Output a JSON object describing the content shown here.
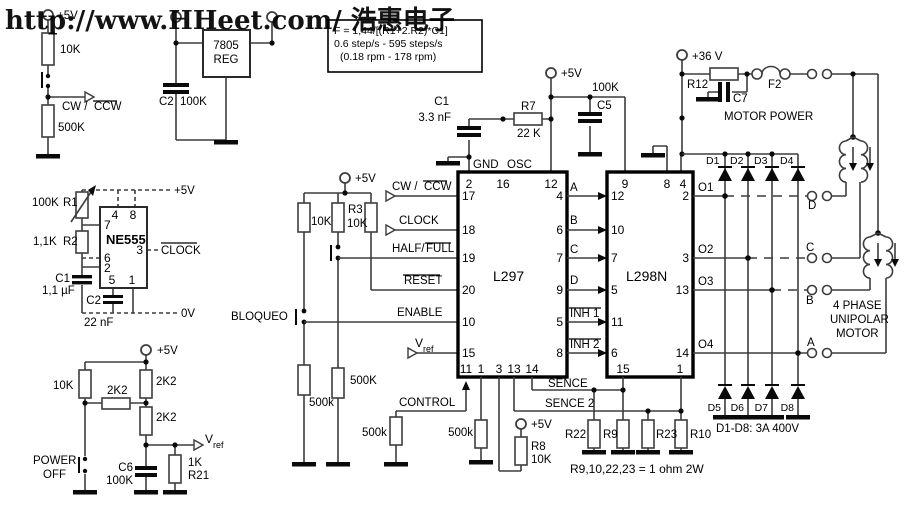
{
  "watermark": {
    "text": "http://www.HHeet.com/ 浩惠电子",
    "color": "#e60000"
  },
  "formula_box": {
    "line1": "F = 1,44/[(R1+2.R2)*C1]",
    "line2": "0.6 step/s - 595 steps/s",
    "line3": "(0.18 rpm - 178 rpm)"
  },
  "supply": {
    "v5": "+5V",
    "v36": "+36 V",
    "v0": "0V",
    "motor_power": "MOTOR POWER"
  },
  "chips": {
    "l297": {
      "name": "L297",
      "top": [
        "2",
        "16",
        "12"
      ],
      "left": [
        "17",
        "18",
        "19",
        "20",
        "10",
        "15"
      ],
      "right": [
        "4",
        "6",
        "7",
        "9",
        "5",
        "8"
      ],
      "bottom": [
        "11",
        "1",
        "3",
        "13",
        "14"
      ]
    },
    "l298": {
      "name": "L298N",
      "top": [
        "9",
        "8",
        "4"
      ],
      "left": [
        "12",
        "10",
        "7",
        "5",
        "11",
        "6"
      ],
      "right": [
        "2",
        "3",
        "13",
        "14"
      ],
      "bottom": [
        "15",
        "1"
      ]
    },
    "ne555": {
      "name": "NE555",
      "pins": [
        "4",
        "8",
        "7",
        "6",
        "2",
        "3",
        "5",
        "1"
      ]
    },
    "reg": {
      "line1": "7805",
      "line2": "REG"
    }
  },
  "signals": {
    "cw": "CW /",
    "ccw": "CCW",
    "clock": "CLOCK",
    "half": "HALF/",
    "full": "FULL",
    "reset": "RESET",
    "enable": "ENABLE",
    "control": "CONTROL",
    "bloqueo": "BLOQUEO",
    "sence": "SENCE",
    "sence2": "SENCE 2",
    "inh1": "INH 1",
    "inh2": "INH 2",
    "gnd": "GND",
    "osc": "OSC",
    "vref_v": "V",
    "vref_sub": "ref",
    "o1": "O1",
    "o2": "O2",
    "o3": "O3",
    "o4": "O4",
    "a": "A",
    "b": "B",
    "c": "C",
    "d": "D",
    "power": "POWER",
    "off": "OFF"
  },
  "components": {
    "r10k": "10K",
    "r500K": "500K",
    "r500k": "500k",
    "r2k2": "2K2",
    "v100K": "100K",
    "r1": "R1",
    "r2": "R2",
    "r2v": "1,1K",
    "r3": "R3",
    "r7": "R7",
    "r7v": "22 K",
    "r8": "R8",
    "r12": "R12",
    "r21": "R21",
    "r21v": "1K",
    "r22": "R22",
    "r9": "R9",
    "r23": "R23",
    "r10": "R10",
    "c1o": "C1",
    "c1ov": "3.3 nF",
    "c2r": "C2",
    "c5": "C5",
    "c6": "C6",
    "c7": "C7",
    "c1t": "C1",
    "c1tv": "1,1 µF",
    "c2t": "C2",
    "c2tv": "22 nF",
    "f2": "F2",
    "d1": "D1",
    "d2": "D2",
    "d3": "D3",
    "d4": "D4",
    "d5": "D5",
    "d6": "D6",
    "d7": "D7",
    "d8": "D8"
  },
  "motor": {
    "line1": "4 PHASE",
    "line2": "UNIPOLAR",
    "line3": "MOTOR"
  },
  "notes": {
    "diodes": "D1-D8: 3A 400V",
    "resistors": "R9,10,22,23 = 1 ohm 2W"
  }
}
